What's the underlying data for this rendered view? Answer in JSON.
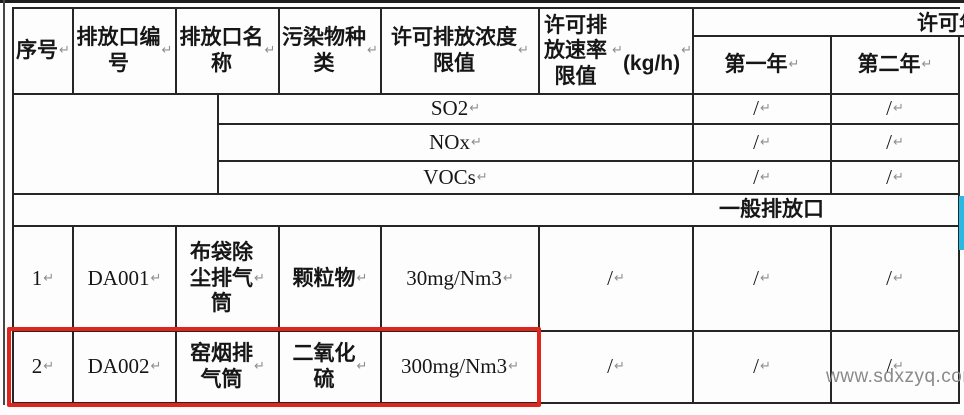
{
  "colors": {
    "highlight_box_red": "#e0251c",
    "right_edge_cyan": "#29b9e3",
    "watermark_gray": "#8a8a8a",
    "table_border": "#262626"
  },
  "table": {
    "header": {
      "col_seq": "序号↵",
      "col_outlet_no": "排放口编\n号↵",
      "col_outlet_name": "排放口名\n称↵",
      "col_pollutant_type": "污染物种\n类↵",
      "col_conc_limit": "许可排放浓度\n限值↵",
      "col_rate_limit": "许可排放速率\n限值↵\n(kg/h)↵",
      "col_annual_span_clipped": "许可年",
      "col_year1": "第一年↵",
      "col_year2": "第二年↵"
    },
    "pollutant_rows": [
      {
        "pollutant": "SO2↵",
        "year1": "/↵",
        "year2": "/↵"
      },
      {
        "pollutant": "NOx↵",
        "year1": "/↵",
        "year2": "/↵"
      },
      {
        "pollutant": "VOCs↵",
        "year1": "/↵",
        "year2": "/↵"
      }
    ],
    "section_row_label": "一般排放口↵",
    "data_rows": [
      {
        "seq": "1↵",
        "outlet_no": "DA001↵",
        "outlet_name": "布袋除\n尘排气\n筒↵",
        "pollutant": "颗粒物↵",
        "conc_limit": "30mg/Nm3↵",
        "rate_limit": "/↵",
        "year1": "/↵",
        "year2": "/↵"
      },
      {
        "seq": "2↵",
        "outlet_no": "DA002↵",
        "outlet_name": "窑烟排\n气筒↵",
        "pollutant": "二氧化\n硫↵",
        "conc_limit": "300mg/Nm3↵",
        "rate_limit": "/↵",
        "year1": "/↵",
        "year2": "/↵"
      }
    ]
  },
  "watermark_text": "www.sdxzyq.com"
}
